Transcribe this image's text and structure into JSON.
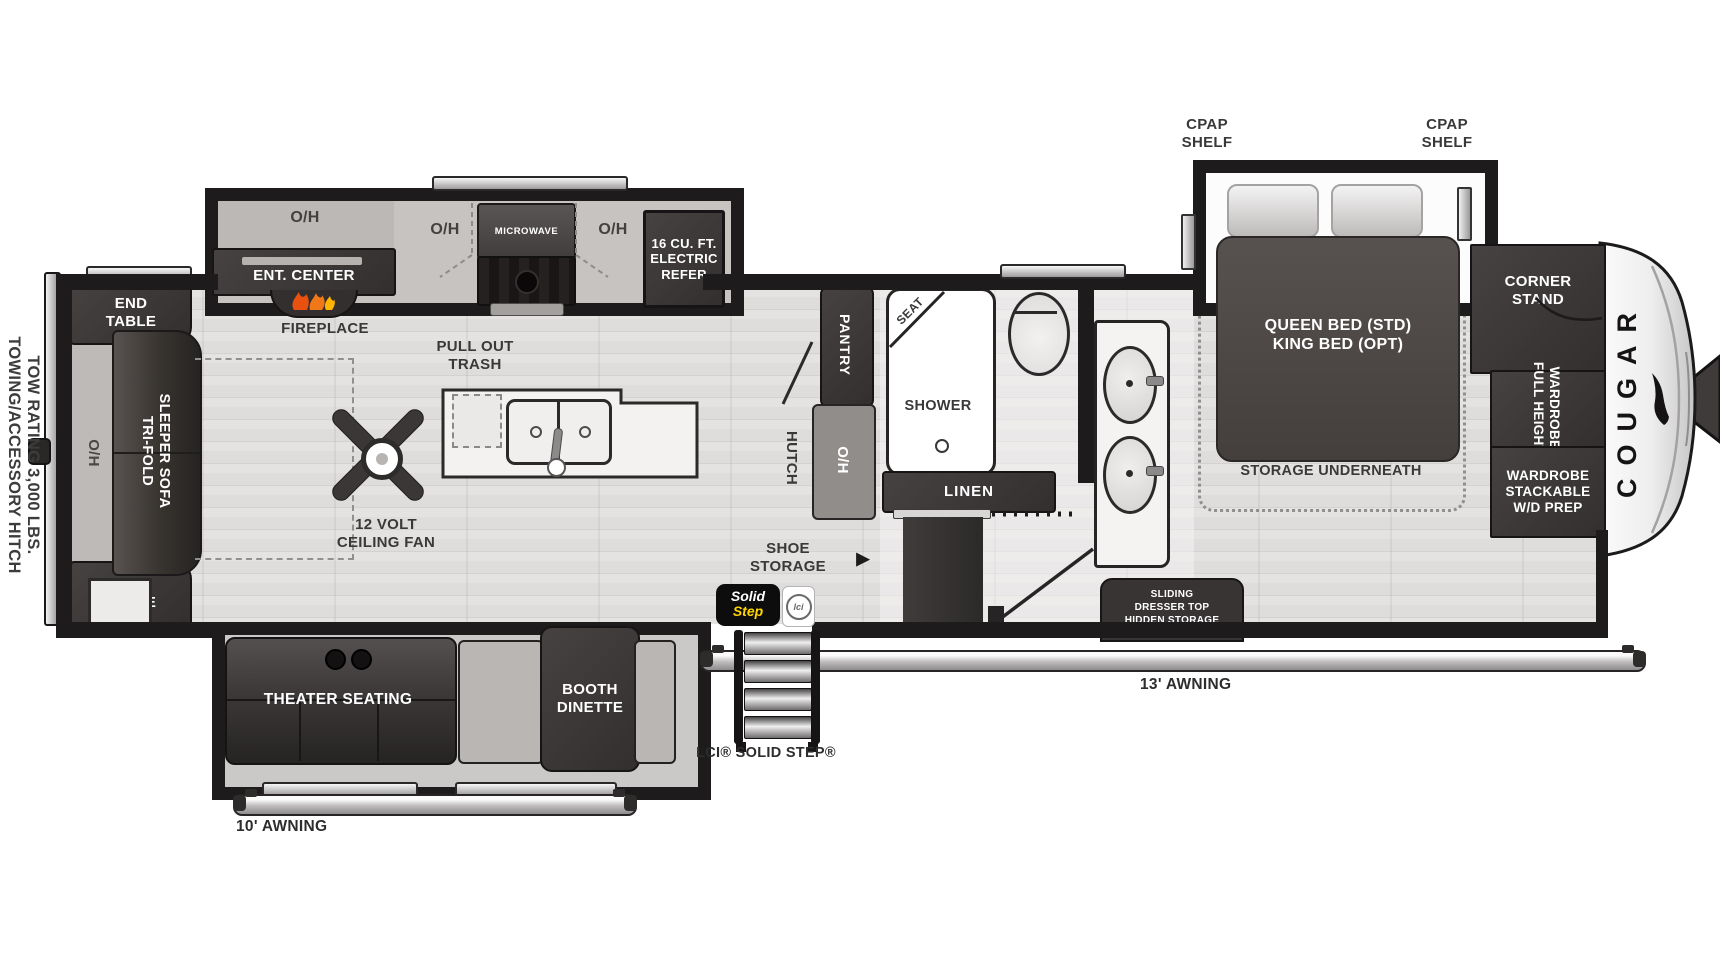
{
  "colors": {
    "wall": "#1d1b1b",
    "furniture_dark": "#3b3737",
    "floor": "#dedddc",
    "badge_yellow": "#ffd400",
    "flame_orange": "#f07818"
  },
  "exterior": {
    "towing_line1": "TOWING/ACCESSORY HITCH",
    "towing_line2": "TOW RATING 3,000 LBS.",
    "awning_left": "10' AWNING",
    "awning_right": "13' AWNING",
    "step_label": "LCI® SOLID STEP®",
    "badge": {
      "word1": "Solid",
      "word2": "Step",
      "logo": "lci"
    }
  },
  "rear": {
    "end_table": "END\nTABLE",
    "oh": "O/H",
    "sofa_line1": "TRI-FOLD",
    "sofa_line2": "SLEEPER SOFA"
  },
  "kitchen": {
    "oh": "O/H",
    "ent_center": "ENT. CENTER",
    "fireplace": "FIREPLACE",
    "microwave": "MICROWAVE",
    "refrigerator": "16 CU. FT.\nELECTRIC\nREFER",
    "trash": "PULL OUT\nTRASH",
    "fan": "12 VOLT\nCEILING FAN",
    "pantry": "PANTRY",
    "hutch": "HUTCH"
  },
  "bath": {
    "seat": "SEAT",
    "shower": "SHOWER",
    "linen": "LINEN",
    "oh": "O/H",
    "shoe_storage": "SHOE\nSTORAGE",
    "shoe_arrow": "▶"
  },
  "bedroom": {
    "cpap": "CPAP\nSHELF",
    "bed": "QUEEN BED (STD)\nKING BED (OPT)",
    "storage": "STORAGE UNDERNEATH",
    "dresser": "SLIDING\nDRESSER TOP\nHIDDEN STORAGE"
  },
  "front": {
    "corner_stand": "CORNER\nSTAND",
    "wardrobe_line1": "FULL HEIGHT",
    "wardrobe_line2": "WARDROBE",
    "wd_prep": "WARDROBE\nSTACKABLE\nW/D PREP",
    "brand": "COUGAR"
  },
  "living_slide": {
    "theater": "THEATER SEATING",
    "booth": "BOOTH\nDINETTE"
  }
}
